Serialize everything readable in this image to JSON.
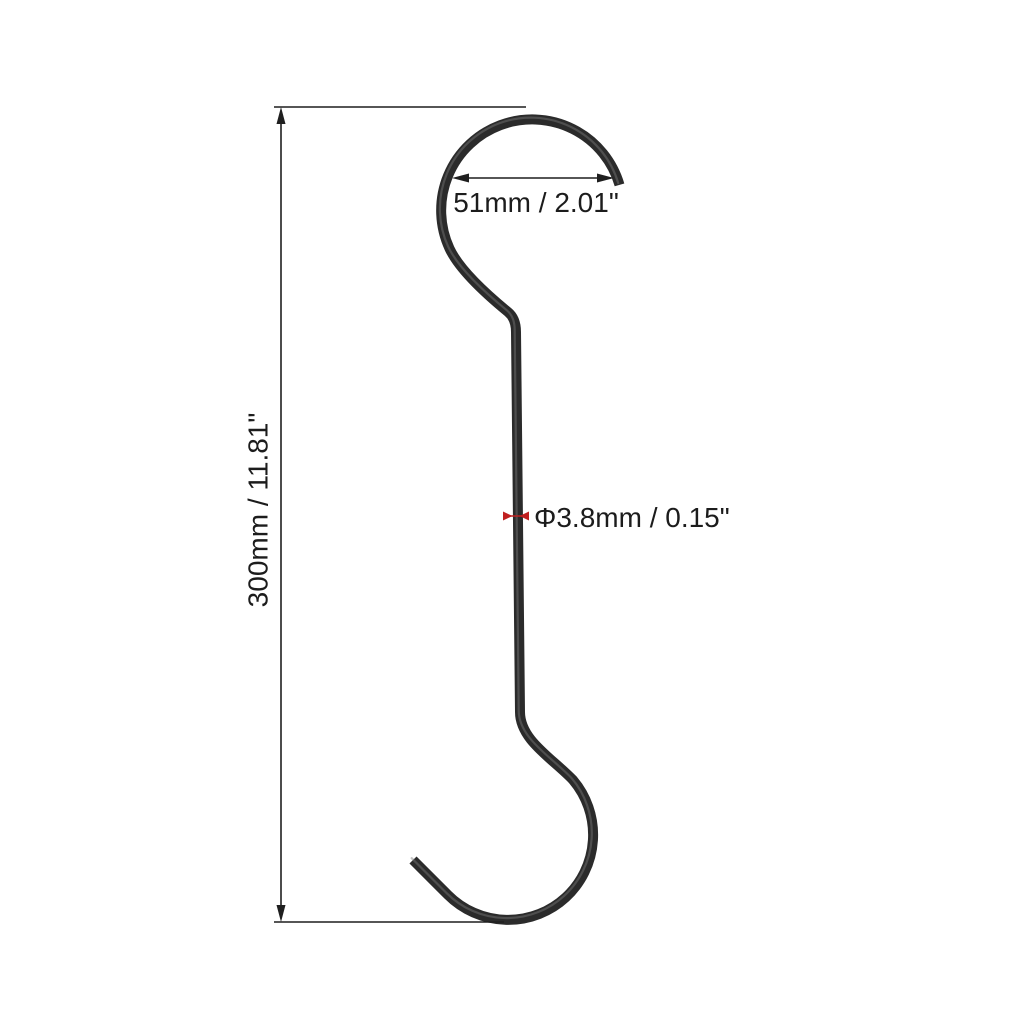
{
  "diagram": {
    "title": "S-hook dimension diagram",
    "labels": {
      "overall_height": "300mm / 11.81\"",
      "hook_opening_width": "51mm / 2.01\"",
      "wire_diameter": "Φ3.8mm / 0.15\""
    },
    "colors": {
      "background": "#ffffff",
      "wire": "#2b2b2b",
      "dimension_line": "#1f1f1f",
      "label_text": "#1c1c1c",
      "diameter_marker": "#c02020"
    }
  }
}
